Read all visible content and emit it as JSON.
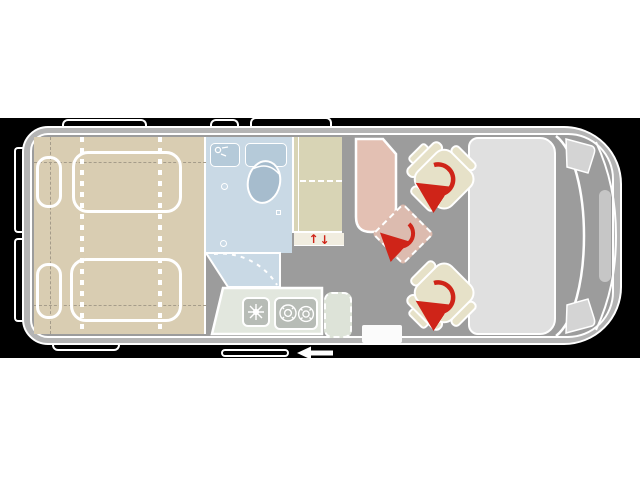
{
  "figure": {
    "type": "campervan-floor-plan",
    "view": "top-down",
    "step_arrows": {
      "up": "↑",
      "down": "↓"
    }
  },
  "colors": {
    "page_bg": "#ffffff",
    "band_bg": "#000000",
    "outline": "#ffffff",
    "body_gray": "#b4b4b4",
    "floor_gray": "#9c9c9c",
    "bed_beige": "#d9cdb2",
    "dash_tan": "#a59c8a",
    "wardrobe_beige": "#d8d4b5",
    "strip_cream": "#f1ede0",
    "bathroom_blue": "#c9d9e5",
    "fixture_blue": "#b5cad9",
    "toilet_blue": "#a6bccd",
    "kitchen_sage": "#e2e7de",
    "flap_sage": "#dde3d8",
    "appliance_gray": "#b7bcb6",
    "table_salmon": "#e3c0b3",
    "diamond_salmon": "#dcbbaf",
    "seat_beige": "#e6e1c8",
    "windshield_gray": "#e0e0e0",
    "light_gray": "#d4d4d4",
    "accent_red": "#cf2418"
  },
  "icons": [
    "seat-swivel-arrow-icon",
    "table-swivel-arrow-icon",
    "step-up-arrow-icon",
    "step-down-arrow-icon",
    "door-slide-arrow-icon",
    "bath-faucet-icon",
    "kitchen-faucet-icon",
    "stove-burner-icon"
  ]
}
